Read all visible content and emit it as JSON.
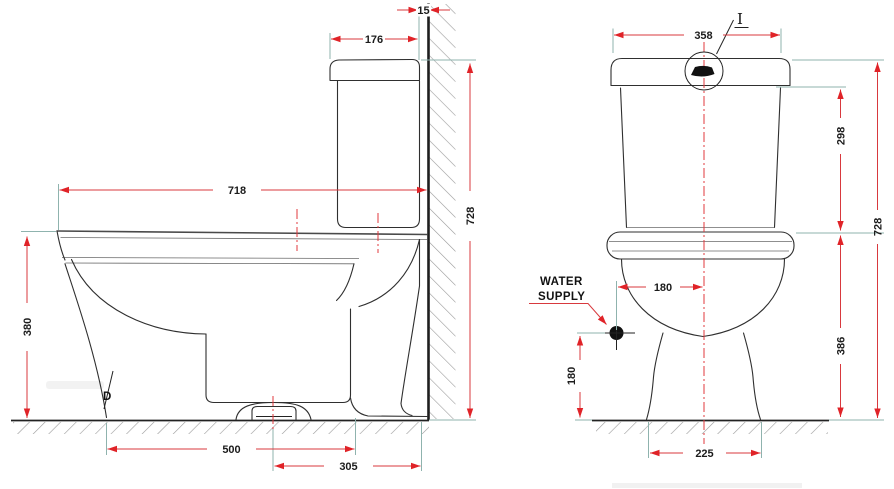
{
  "page": {
    "width": 894,
    "height": 489,
    "background": "#ffffff"
  },
  "colors": {
    "dimension_red": "#d8393e",
    "arrow_red": "#e02328",
    "outline_dark": "#2f2f2f",
    "extension_teal": "#8fb3ae",
    "hatch_gray": "#9b9b9b",
    "text_black": "#1c1c1c"
  },
  "side_view": {
    "dims": {
      "wall_gap": "15",
      "cistern_depth": "176",
      "overall_depth": "718",
      "overall_height": "728",
      "rim_height": "380",
      "front_to_outlet": "500",
      "outlet_to_wall": "305"
    },
    "labels": {
      "detail_d": "D"
    }
  },
  "front_view": {
    "dims": {
      "cistern_width": "358",
      "cistern_height": "298",
      "overall_height": "728",
      "supply_offset": "180",
      "supply_height": "180",
      "rim_height": "386",
      "base_width": "225"
    },
    "labels": {
      "detail_i": "I",
      "water_supply_line1": "WATER",
      "water_supply_line2": "SUPPLY"
    }
  }
}
